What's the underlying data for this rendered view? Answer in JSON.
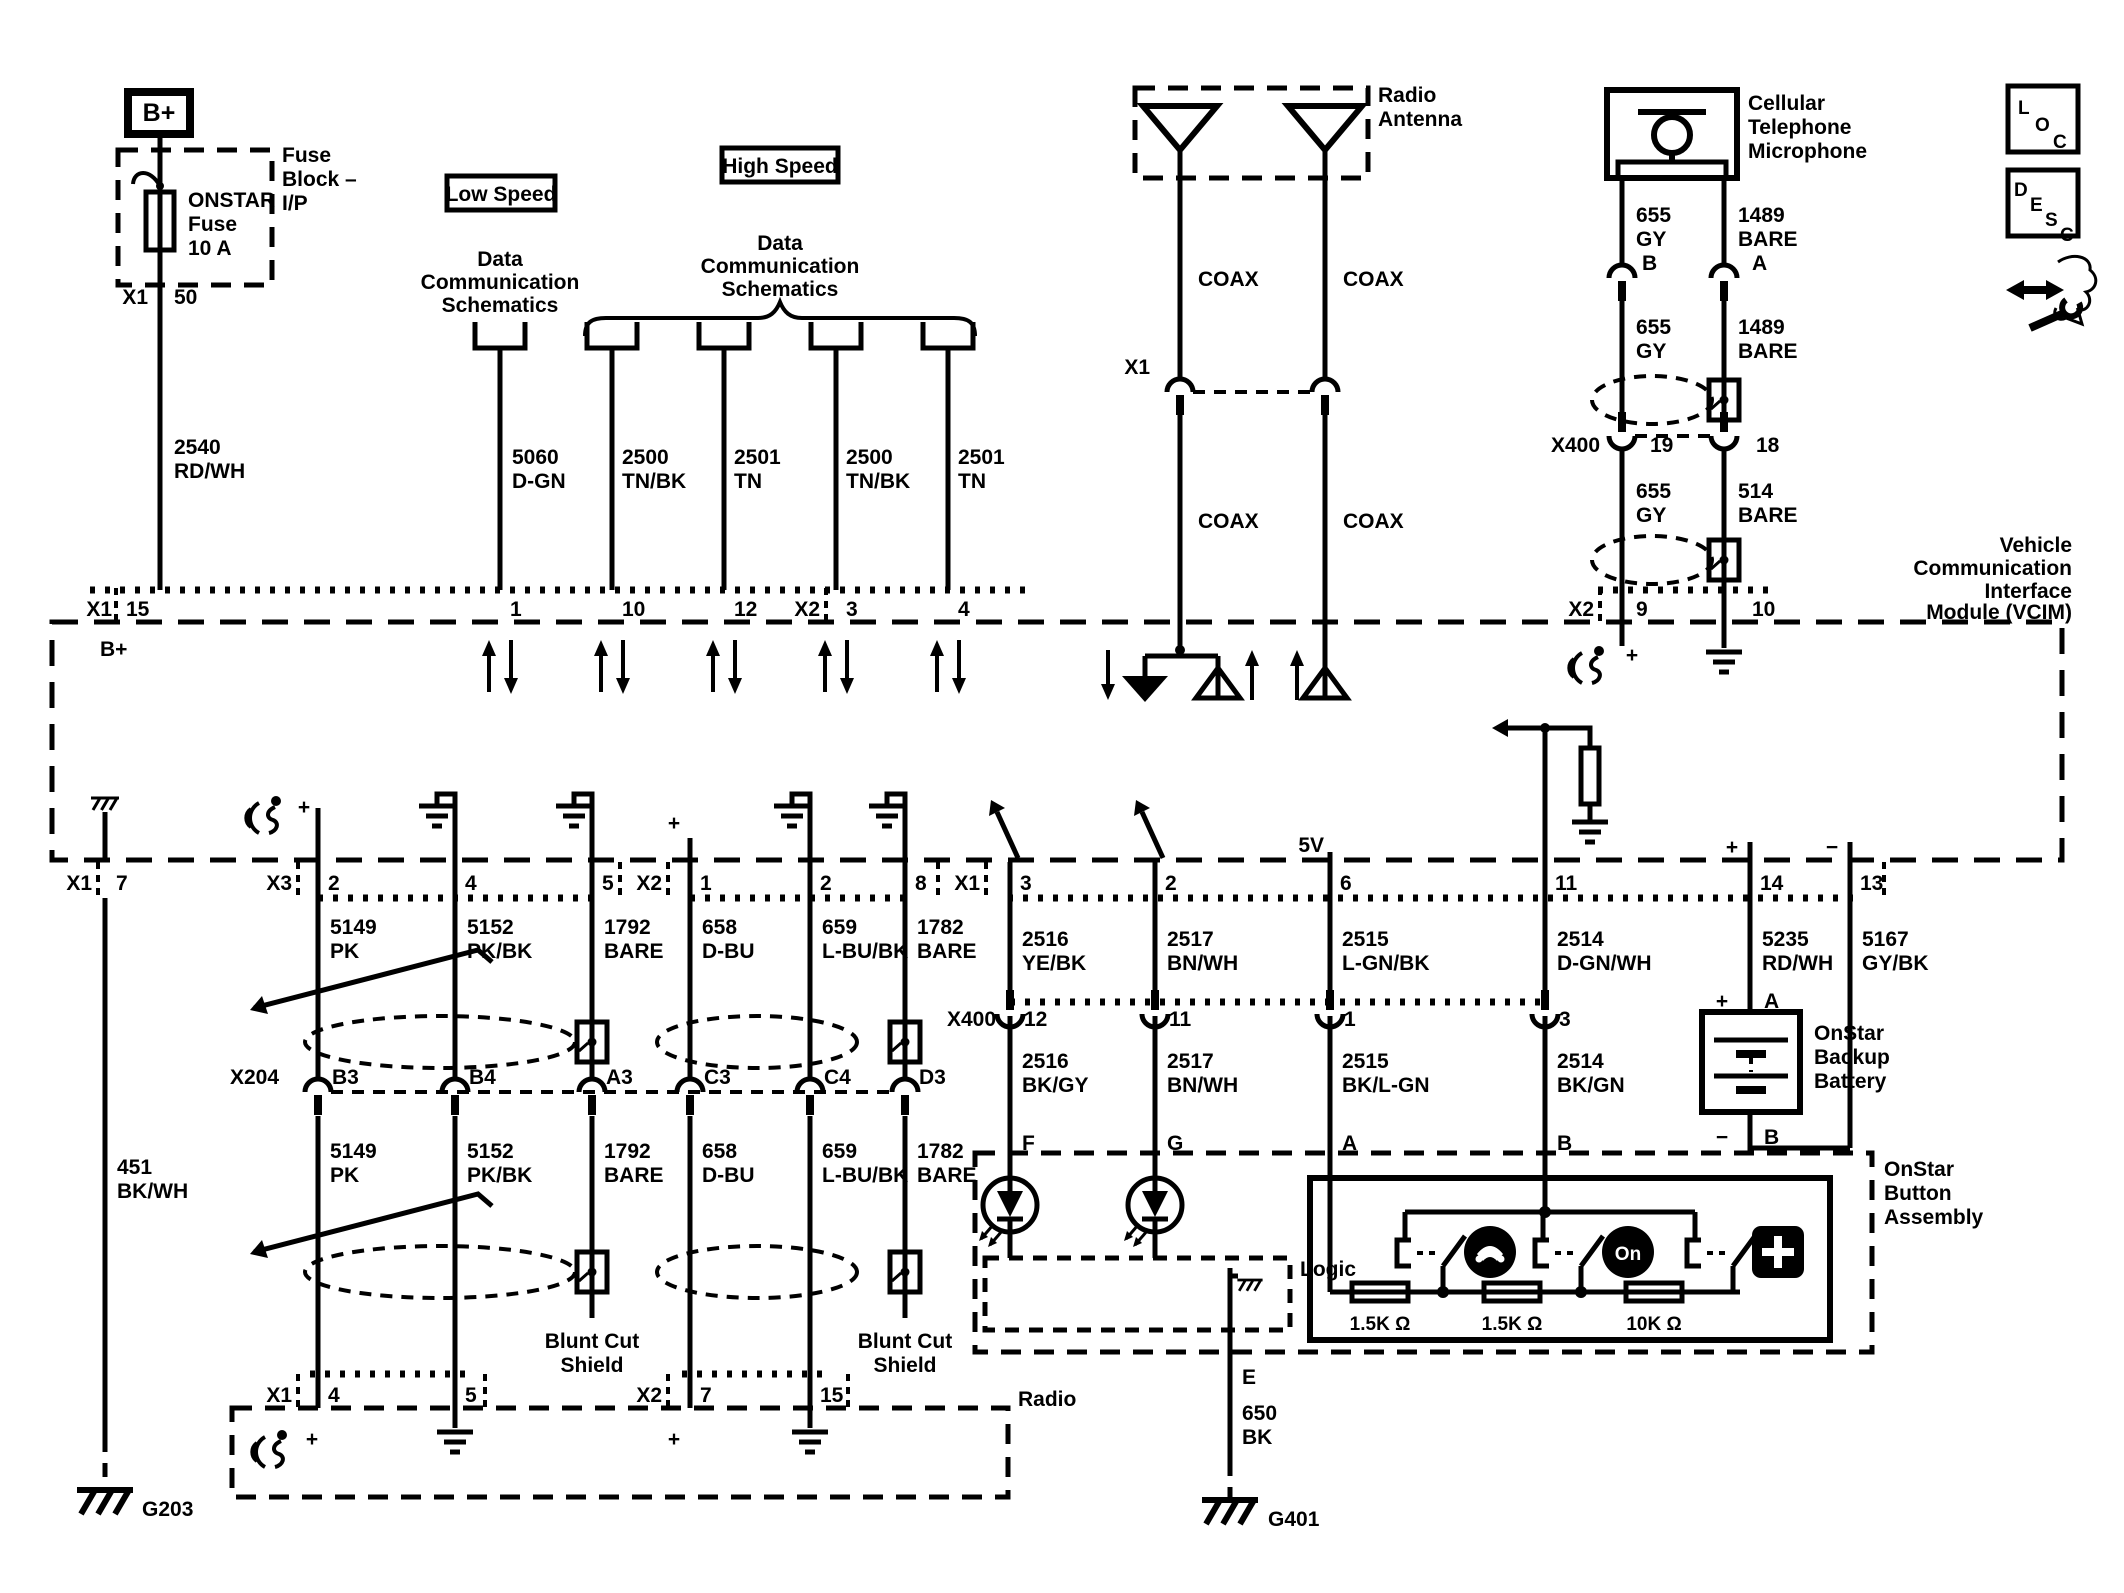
{
  "power": {
    "battery_feed": "B+",
    "fuse_block_label": [
      "Fuse",
      "Block –",
      "I/P"
    ],
    "fuse_label": [
      "ONSTAR",
      "Fuse",
      "10 A"
    ],
    "connector": "X1",
    "fuse_pin": "50",
    "wire": {
      "circuit": "2540",
      "color": "RD/WH"
    },
    "vcim_pin": "15",
    "vcim_net": "B+"
  },
  "buses": {
    "low_speed": {
      "tag": "Low Speed",
      "ref": [
        "Data",
        "Communication",
        "Schematics"
      ],
      "wire": {
        "circuit": "5060",
        "color": "D-GN"
      },
      "pin": "1"
    },
    "high_speed": {
      "tag": "High Speed",
      "ref": [
        "Data",
        "Communication",
        "Schematics"
      ],
      "connector2": "X2",
      "wires": [
        {
          "circuit": "2500",
          "color": "TN/BK",
          "pin": "10"
        },
        {
          "circuit": "2501",
          "color": "TN",
          "pin": "12"
        },
        {
          "circuit": "2500",
          "color": "TN/BK",
          "pin": "3"
        },
        {
          "circuit": "2501",
          "color": "TN",
          "pin": "4"
        }
      ]
    }
  },
  "antenna": {
    "label": [
      "Radio",
      "Antenna"
    ],
    "coax": [
      "COAX",
      "COAX",
      "COAX",
      "COAX"
    ],
    "connector": "X1"
  },
  "microphone": {
    "label": [
      "Cellular",
      "Telephone",
      "Microphone"
    ],
    "seg1": [
      {
        "circuit": "655",
        "color": "GY"
      },
      {
        "circuit": "1489",
        "color": "BARE"
      }
    ],
    "pins": [
      "B",
      "A"
    ],
    "seg2": [
      {
        "circuit": "655",
        "color": "GY"
      },
      {
        "circuit": "1489",
        "color": "BARE"
      }
    ],
    "connector": "X400",
    "connector_pins": [
      "19",
      "18"
    ],
    "seg3": [
      {
        "circuit": "655",
        "color": "GY"
      },
      {
        "circuit": "514",
        "color": "BARE"
      }
    ],
    "vcim_connector": "X2",
    "vcim_pins": [
      "9",
      "10"
    ],
    "polarity": "+"
  },
  "legend": {
    "loc": [
      "L",
      "O",
      "C"
    ],
    "desc": [
      "D",
      "E",
      "S",
      "C"
    ]
  },
  "vcim": {
    "label": [
      "Vehicle",
      "Communication",
      "Interface",
      "Module (VCIM)"
    ],
    "supply": "5V",
    "plus": "+",
    "minus": "−"
  },
  "ground_circuit": {
    "connector": "X1",
    "pin": "7",
    "wire": {
      "circuit": "451",
      "color": "BK/WH"
    },
    "ground": "G203"
  },
  "mic_audio": {
    "connector": "X3",
    "pins": [
      "2",
      "4",
      "5"
    ],
    "polarity": "+",
    "upper_wires": [
      {
        "circuit": "5149",
        "color": "PK"
      },
      {
        "circuit": "5152",
        "color": "PK/BK"
      },
      {
        "circuit": "1792",
        "color": "BARE"
      }
    ],
    "lower_wires": [
      {
        "circuit": "5149",
        "color": "PK"
      },
      {
        "circuit": "5152",
        "color": "PK/BK"
      },
      {
        "circuit": "1792",
        "color": "BARE"
      }
    ],
    "blunt": [
      "Blunt Cut",
      "Shield"
    ]
  },
  "spk_audio": {
    "connector": "X2",
    "pins": [
      "1",
      "2",
      "8"
    ],
    "polarity": "+",
    "upper_wires": [
      {
        "circuit": "658",
        "color": "D-BU"
      },
      {
        "circuit": "659",
        "color": "L-BU/BK"
      },
      {
        "circuit": "1782",
        "color": "BARE"
      }
    ],
    "lower_wires": [
      {
        "circuit": "658",
        "color": "D-BU"
      },
      {
        "circuit": "659",
        "color": "L-BU/BK"
      },
      {
        "circuit": "1782",
        "color": "BARE"
      }
    ],
    "blunt": [
      "Blunt Cut",
      "Shield"
    ]
  },
  "x204": {
    "label": "X204",
    "pins": [
      "B3",
      "B4",
      "A3",
      "C3",
      "C4",
      "D3"
    ]
  },
  "radio": {
    "label": "Radio",
    "connector1": "X1",
    "pins1": [
      "4",
      "5"
    ],
    "connector2": "X2",
    "pins2": [
      "7",
      "15"
    ],
    "polarity": "+"
  },
  "button_circuit": {
    "connector": "X1",
    "pins": [
      "3",
      "2"
    ],
    "pin_5v": "6",
    "pin_led": "11",
    "pin_plus": "14",
    "pin_minus": "13",
    "upper_wires": [
      {
        "circuit": "2516",
        "color": "YE/BK"
      },
      {
        "circuit": "2517",
        "color": "BN/WH"
      },
      {
        "circuit": "2515",
        "color": "L-GN/BK"
      },
      {
        "circuit": "2514",
        "color": "D-GN/WH"
      }
    ],
    "x400": {
      "label": "X400",
      "pins": [
        "12",
        "11",
        "1",
        "3"
      ]
    },
    "lower_wires": [
      {
        "circuit": "2516",
        "color": "BK/GY"
      },
      {
        "circuit": "2517",
        "color": "BN/WH"
      },
      {
        "circuit": "2515",
        "color": "BK/L-GN"
      },
      {
        "circuit": "2514",
        "color": "BK/GN"
      }
    ],
    "assembly_pins": [
      "F",
      "G",
      "A",
      "B"
    ]
  },
  "battery": {
    "wire_pos": {
      "circuit": "5235",
      "color": "RD/WH"
    },
    "wire_neg": {
      "circuit": "5167",
      "color": "GY/BK"
    },
    "plus": "+",
    "pin_a": "A",
    "label": [
      "OnStar",
      "Backup",
      "Battery"
    ],
    "minus": "−",
    "pin_b": "B"
  },
  "assembly": {
    "label": [
      "OnStar",
      "Button",
      "Assembly"
    ],
    "logic": "Logic",
    "pin_e": "E",
    "wire": {
      "circuit": "650",
      "color": "BK"
    },
    "ground": "G401",
    "resistors": [
      "1.5K Ω",
      "1.5K Ω",
      "10K Ω"
    ],
    "buttons": {
      "phone_icon": "phone-button",
      "onstar_label": "On",
      "emergency_icon": "emergency-button"
    }
  }
}
